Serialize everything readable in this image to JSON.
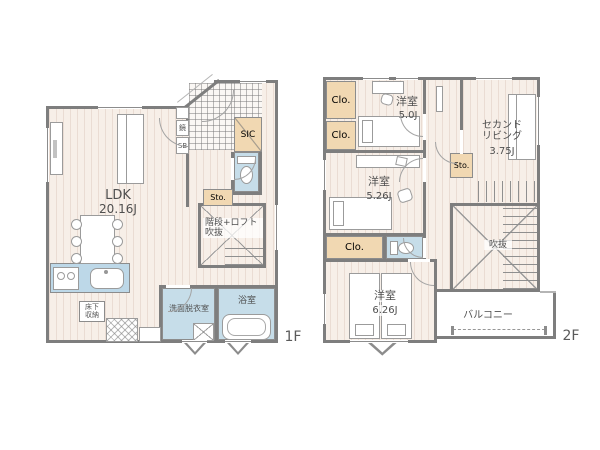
{
  "colors": {
    "wall": "#7e7e7e",
    "floor_stripe": "#f7efe8",
    "wet_room": "#c6dde9",
    "kitchen_counter": "#bdd8e8",
    "closet": "#f1d8b2"
  },
  "floor1": {
    "floor_label": "1F",
    "ldk_name": "LDK",
    "ldk_size": "20.16J",
    "mirror": "鏡",
    "shoe_box": "SB",
    "shoe_closet": "SIC",
    "storage": "Sto.",
    "stair_loft_void": "階段+ロフト\n吹抜",
    "washroom": "洗面脱衣室",
    "bathroom": "浴室",
    "underfloor_storage": "床下\n収納"
  },
  "floor2": {
    "floor_label": "2F",
    "closet_a": "Clo.",
    "closet_b": "Clo.",
    "closet_c": "Clo.",
    "bedroom_50_name": "洋室",
    "bedroom_50_size": "5.0J",
    "second_living_name": "セカンド\nリビング",
    "second_living_size": "3.75J",
    "storage": "Sto.",
    "bedroom_526_name": "洋室",
    "bedroom_526_size": "5.26J",
    "bedroom_626_name": "洋室",
    "bedroom_626_size": "6.26J",
    "void": "吹抜",
    "balcony": "バルコニー"
  }
}
